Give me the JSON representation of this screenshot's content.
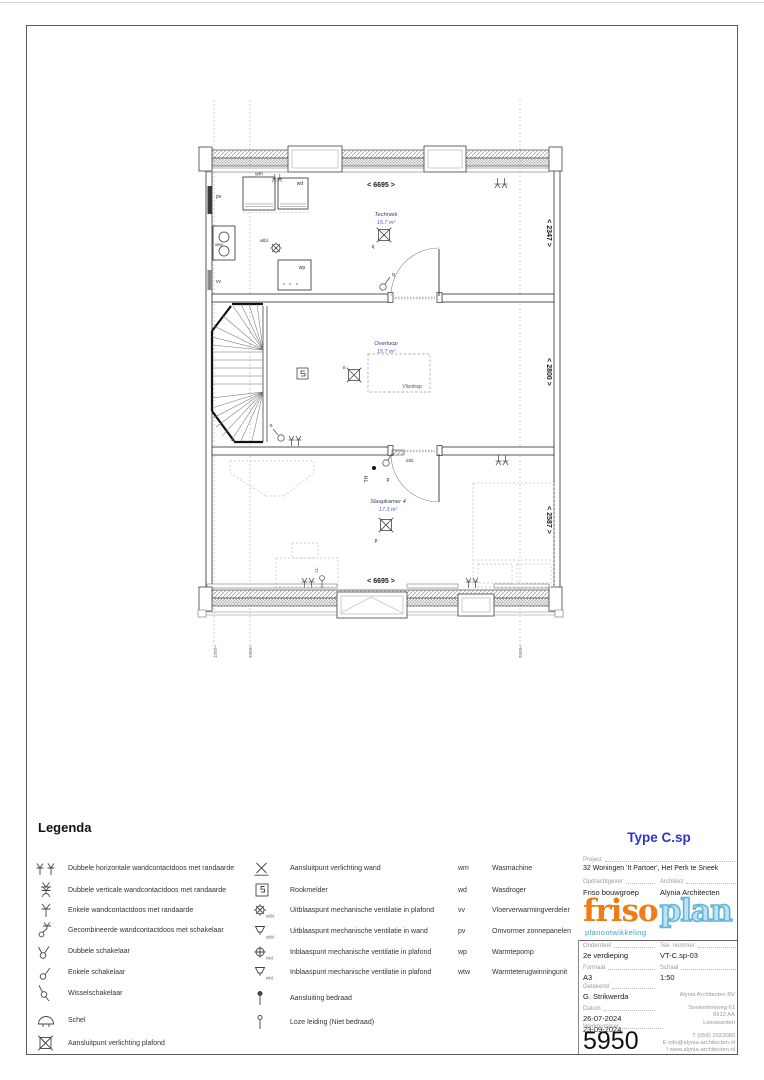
{
  "plan": {
    "rooms": [
      {
        "name": "Techniek",
        "area": "15.7 m²"
      },
      {
        "name": "Overloop",
        "area": "15.7 m²"
      },
      {
        "name": "Slaapkamer 4",
        "area": "17.3 m²"
      }
    ],
    "labels": {
      "vlizotrap": "Vlizotrap",
      "dim_top": "< 6695 >",
      "dim_bottom": "< 6695 >",
      "dim_right_top": "< 2347 >",
      "dim_right_mid": "< 2800 >",
      "dim_right_bottom": "< 2587 >",
      "grid_left": "1500+",
      "grid_mid": "2600+",
      "grid_right": "2600+",
      "pv": "pv",
      "wtw": "wtw",
      "vv": "vv",
      "wm": "wm",
      "wd": "wd",
      "wp": "wp",
      "uitbl": "uitbl.",
      "inbl": "inbl.",
      "q": "q",
      "o": "o",
      "p": "p",
      "th": "TH",
      "ll": "LL"
    }
  },
  "legend": {
    "title": "Legenda",
    "icon_captions": {
      "uitbl": "uitbl.",
      "inbl": "inbl."
    },
    "col1": [
      "Dubbele horizontale wandcontactdoos met randaarde",
      "Dubbele verticale wandcontactdoos met randaarde",
      "Enkele wandcontactdoos met randaarde",
      "Gecombineerde wandcontactdoos met schakelaar",
      "Dubbele schakelaar",
      "Enkele schakelaar",
      "Wisselschakelaar",
      "Schel",
      "Aansluitpunt verlichting plafond"
    ],
    "col2": [
      "Aansluitpunt verlichting wand",
      "Rookmelder",
      "Uitblaaspunt mechanische ventilatie in plafond",
      "Uitblaaspunt mechanische ventilatie in wand",
      "Inblaaspunt mechanische ventilatie in plafond",
      "Inblaaspunt mechanische ventilatie in plafond",
      "Aansluiting bedraad",
      "Loze leiding (Niet bedraad)"
    ],
    "col3": [
      {
        "abbr": "wm",
        "label": "Wasmachine"
      },
      {
        "abbr": "wd",
        "label": "Wasdroger"
      },
      {
        "abbr": "vv",
        "label": "Vloerverwarmingverdeler"
      },
      {
        "abbr": "pv",
        "label": "Omvormer zonnepanelen"
      },
      {
        "abbr": "wp",
        "label": "Warmtepomp"
      },
      {
        "abbr": "wtw",
        "label": "Warmteterugwinningunit"
      }
    ]
  },
  "titleblock": {
    "type": "Type C.sp",
    "project_label": "Project",
    "project": "32 Woningen 'It Partoer', Het Perk te Sneek",
    "client_label": "Opdrachtgever",
    "client": "Friso bouwgroep",
    "architect_label": "Architect",
    "architect": "Alynia Architecten",
    "logo_friso": "friso",
    "logo_plan": "plan",
    "logo_sub": "planontwikkeling",
    "part_label": "Onderdeel",
    "part": "2e verdieping",
    "dwgno_label": "Tek. nummer",
    "dwgno": "VT-C.sp-03",
    "format_label": "Formaat",
    "format": "A3",
    "scale_label": "Schaal",
    "scale": "1:50",
    "drawn_label": "Getekend",
    "drawn": "G. Strikwerda",
    "date_label": "Datum",
    "date1": "26-07-2024",
    "date2": "23-09-2024",
    "worknr_label": "Werknummer",
    "worknr": "5950",
    "office_name": "Alynia Architecten BV",
    "office_street": "Snekertrekweg 61",
    "office_zip": "8912 AA",
    "office_city": "Leeuwarden",
    "office_tel": "T (058) 2023080",
    "office_email": "E info@alynia-architecten.nl",
    "office_web": "I www.alynia-architecten.nl"
  },
  "colors": {
    "accent_blue": "#2d35cc",
    "logo_orange": "#ee7d18",
    "logo_blue": "#5fb6da",
    "area_blue": "#4a5fc0"
  }
}
